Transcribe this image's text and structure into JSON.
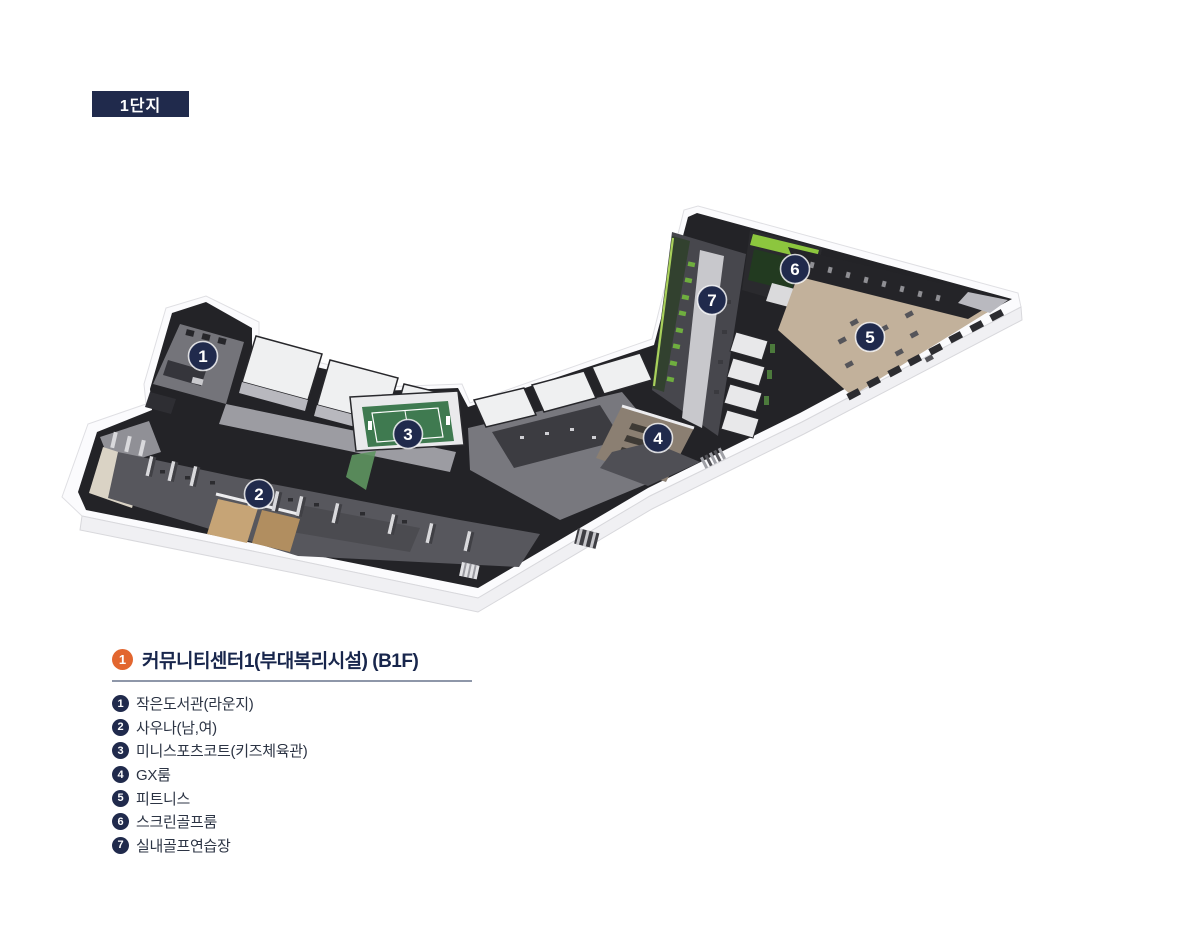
{
  "badge": {
    "label": "1단지",
    "bg": "#202a4c"
  },
  "legend": {
    "title": {
      "number": "1",
      "text": "커뮤니티센터1(부대복리시설) (B1F)",
      "circle_color": "#e2662f"
    },
    "items": [
      {
        "number": "1",
        "label": "작은도서관(라운지)"
      },
      {
        "number": "2",
        "label": "사우나(남,여)"
      },
      {
        "number": "3",
        "label": "미니스포츠코트(키즈체육관)"
      },
      {
        "number": "4",
        "label": "GX룸"
      },
      {
        "number": "5",
        "label": "피트니스"
      },
      {
        "number": "6",
        "label": "스크린골프룸"
      },
      {
        "number": "7",
        "label": "실내골프연습장"
      }
    ],
    "marker_color": "#202a4c"
  },
  "floorplan": {
    "markers": [
      {
        "number": "1",
        "x": 203,
        "y": 356,
        "room": "작은도서관(라운지)"
      },
      {
        "number": "2",
        "x": 259,
        "y": 494,
        "room": "사우나(남,여)"
      },
      {
        "number": "3",
        "x": 408,
        "y": 434,
        "room": "미니스포츠코트(키즈체육관)"
      },
      {
        "number": "4",
        "x": 658,
        "y": 438,
        "room": "GX룸"
      },
      {
        "number": "5",
        "x": 870,
        "y": 337,
        "room": "피트니스"
      },
      {
        "number": "6",
        "x": 795,
        "y": 269,
        "room": "스크린골프룸"
      },
      {
        "number": "7",
        "x": 712,
        "y": 300,
        "room": "실내골프연습장"
      }
    ],
    "colors": {
      "court_green": "#3f7a50",
      "golf_green": "#8cc63e",
      "fitness_tan": "#c2b19b",
      "wall_dark": "#232327"
    }
  }
}
